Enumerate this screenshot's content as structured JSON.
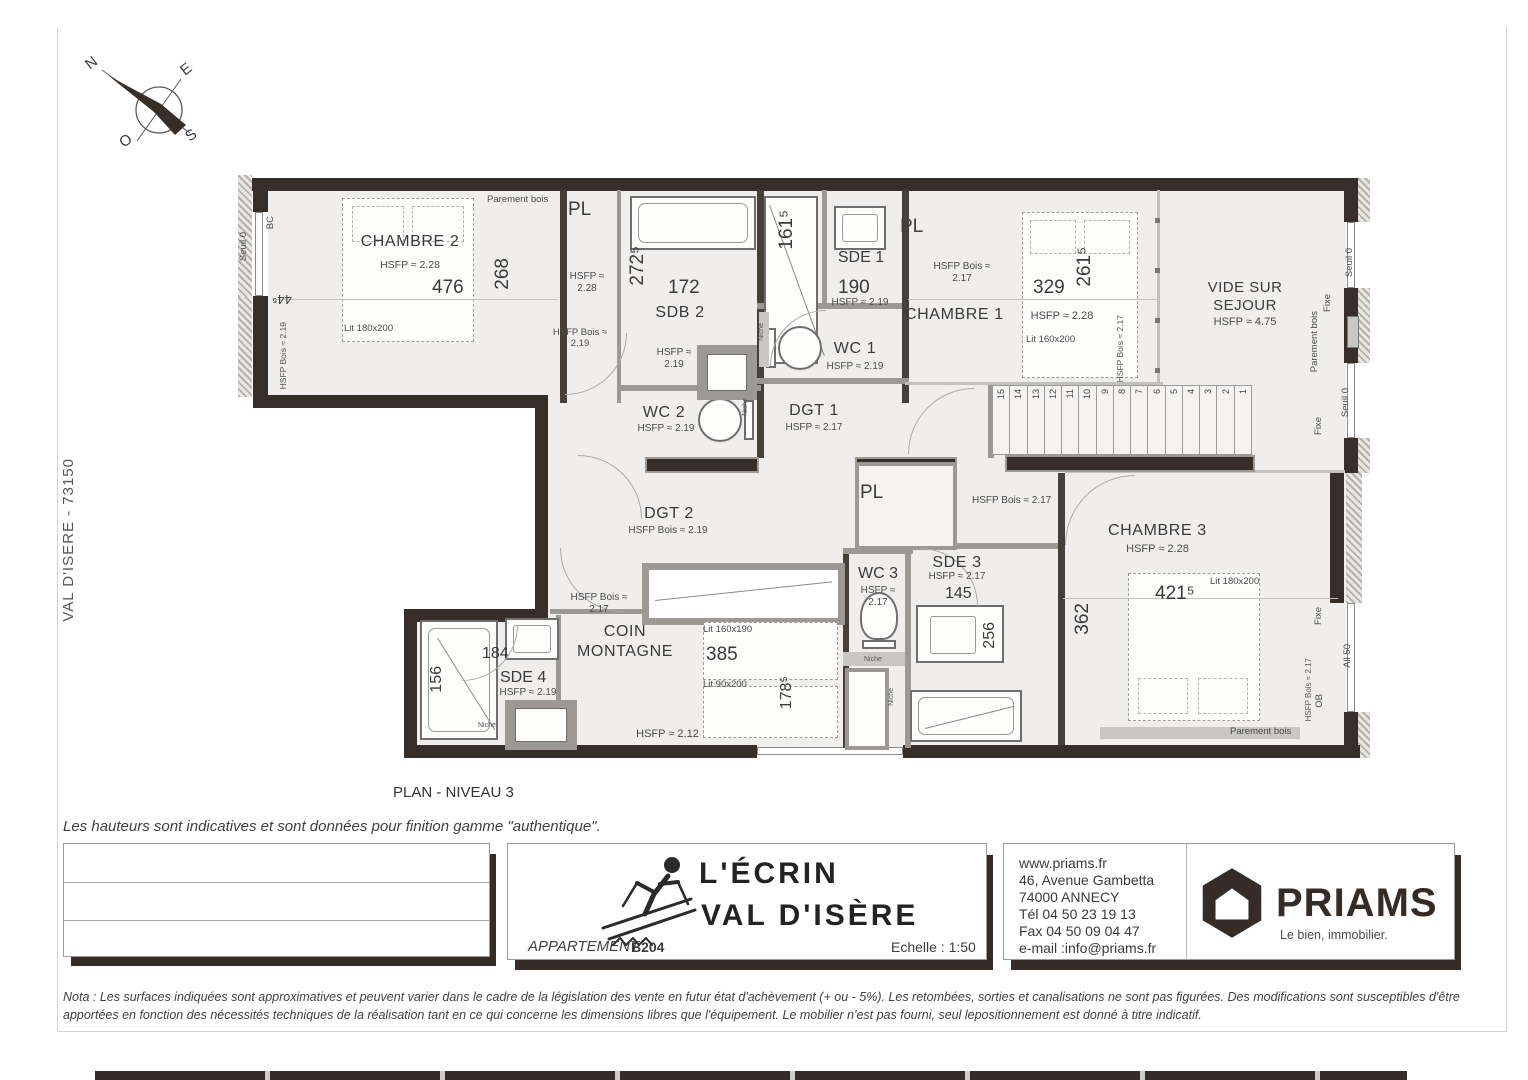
{
  "sheet": {
    "side_text": "VAL D'ISERE  -  73150",
    "plan_title": "PLAN - NIVEAU 3",
    "heights_note": "Les hauteurs sont indicatives et sont données pour finition gamme \"authentique\".",
    "nota_line1": "Nota : Les surfaces indiquées sont approximatives et peuvent varier dans le cadre de la législation des vente en futur état d'achèvement (+ ou - 5%). Les retombées, sorties et canalisations ne sont pas figurées. Des modifications sont susceptibles d'être",
    "nota_line2": "apportées en fonction des nécessités techniques de la réalisation tant en ce qui concerne les dimensions libres que l'équipement. Le mobilier n'est pas fourni, seul lepositionnement est donné à titre indicatif."
  },
  "compass": {
    "n": "N",
    "e": "E",
    "o": "O",
    "s": "S"
  },
  "plan": {
    "parement_bois": "Parement bois",
    "seuil0": "Seuil 0",
    "fixe": "Fixe",
    "bc": "BC",
    "ob": "OB",
    "all50": "All 50",
    "niche": "Niche",
    "pl": "PL",
    "pl1_hsfp": "HSFP ≈ 2.28",
    "chambre2": {
      "name": "CHAMBRE 2",
      "hsfp": "HSFP ≈ 2.28",
      "w": "476",
      "h": "268",
      "lit": "Lit 180x200",
      "corner": "44⁵",
      "wall_hsfp": "HSFP Bois ≈ 2.19"
    },
    "sdb2": {
      "name": "SDB 2",
      "hsfp": "HSFP ≈ 2.19",
      "w": "172",
      "h": "272⁵"
    },
    "shower_dim": "161⁵",
    "sde1": {
      "name": "SDE 1",
      "w": "190",
      "hsfp": "HSFP ≈ 2.19"
    },
    "wc1": {
      "name": "WC 1",
      "hsfp": "HSFP ≈ 2.19"
    },
    "wc2": {
      "name": "WC 2",
      "hsfp": "HSFP ≈ 2.19"
    },
    "dgt1": {
      "name": "DGT 1",
      "hsfp": "HSFP ≈ 2.17"
    },
    "hall_hsfp": "HSFP Bois ≈ 2.19",
    "chambre1": {
      "name": "CHAMBRE 1",
      "hsfp_bois": "HSFP Bois ≈ 2.17",
      "hsfp": "HSFP ≈ 2.28",
      "w": "329",
      "h": "261⁵",
      "lit": "Lit 160x200",
      "side": "HSFP Bois ≈ 2.17"
    },
    "vide": {
      "line1": "VIDE SUR",
      "line2": "SEJOUR",
      "hsfp": "HSFP ≈ 4.75"
    },
    "stairs": [
      "15",
      "14",
      "13",
      "12",
      "11",
      "10",
      "9",
      "8",
      "7",
      "6",
      "5",
      "4",
      "3",
      "2",
      "1"
    ],
    "dgt2": {
      "name": "DGT 2",
      "hsfp": "HSFP Bois ≈ 2.19"
    },
    "pl3_hsfp": "HSFP Bois ≈ 2.17",
    "wc3": {
      "name": "WC 3",
      "hsfp": "HSFP ≈ 2.17"
    },
    "sde3": {
      "name": "SDE 3",
      "hsfp": "HSFP ≈ 2.17",
      "w": "145",
      "basin": "256",
      "h": "362"
    },
    "chambre3": {
      "name": "CHAMBRE 3",
      "hsfp": "HSFP ≈ 2.28",
      "w": "421⁵",
      "lit": "Lit 180x200",
      "side": "HSFP Bois ≈ 2.17"
    },
    "coin": {
      "name1": "COIN",
      "name2": "MONTAGNE",
      "above_hsfp": "HSFP Bois ≈ 2.17",
      "lit1": "Lit 160x190",
      "w": "385",
      "lit2": "Lit 90x200",
      "h": "178⁵",
      "low_hsfp": "HSFP ≈ 2.12"
    },
    "sde4": {
      "name": "SDE 4",
      "hsfp": "HSFP ≈ 2.19",
      "w": "184",
      "h": "156"
    }
  },
  "titleblock": {
    "residence_line1": "L'ÉCRIN",
    "residence_line2": "VAL D'ISÈRE",
    "apartment_label": "APPARTEMENT:",
    "apartment_value": "B204",
    "scale": "Echelle : 1:50",
    "contact": [
      "www.priams.fr",
      "46, Avenue Gambetta",
      "74000 ANNECY",
      "Tél 04 50 23 19 13",
      "Fax 04 50 09 04 47",
      "e-mail :info@priams.fr"
    ],
    "brand": "PRIAMS",
    "brand_tagline": "Le bien, immobilier."
  }
}
